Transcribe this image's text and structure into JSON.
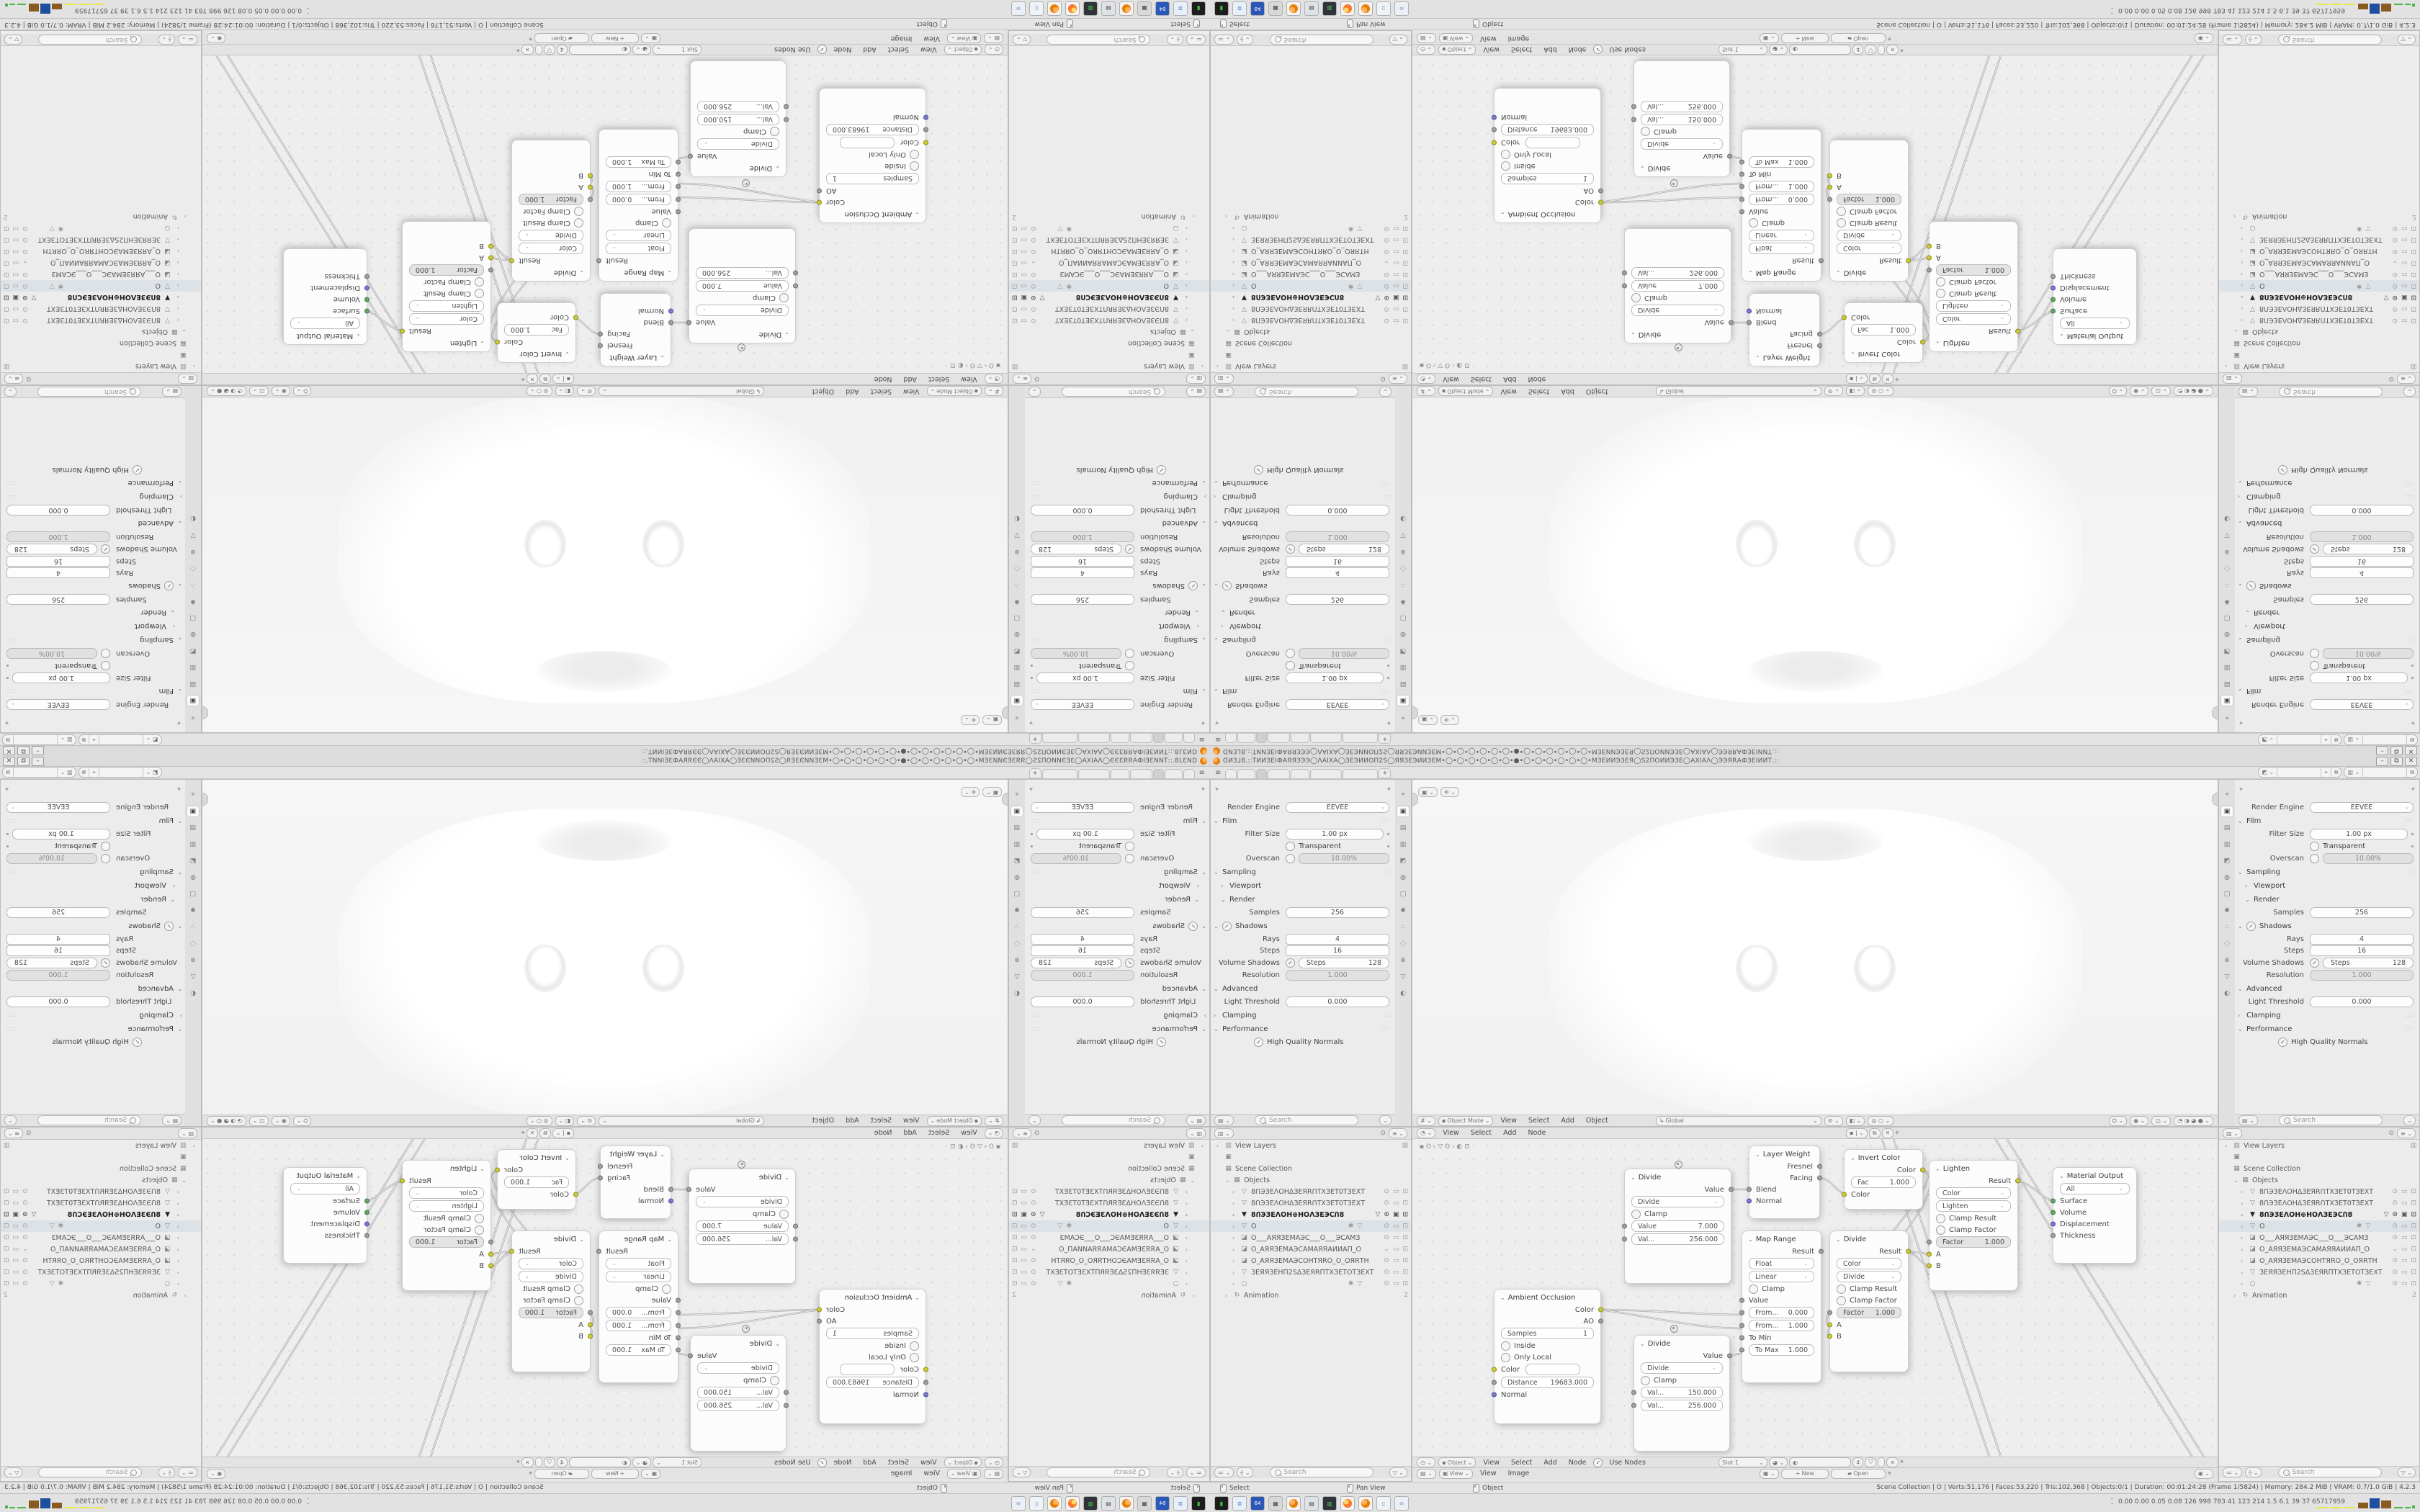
{
  "window": {
    "title": "ᗡИЗ⅃8.::ТИИЗЕІФАЯЯЗЭЭ◯ΛАІХА◯ЗЕЭИИОП2Ѕ◯ЯЯЗЕЭИИЗЕМ•◯•◯•◯•◯•◯•◯•●•◯•◯•◯•◯•◯•◯•МЗЕИИЭЗЕЯ◯Ѕ2ПОИИЭЗЕ◯АХІАΛ◯ЭЭЯRАФЗЕІИИТ.::",
    "minimize": "–",
    "restore": "⧉",
    "close": "✕"
  },
  "topbar": {
    "menu_icon": "≡",
    "new_tab": "+"
  },
  "viewport_header": {
    "mode": "Object Mode",
    "menus": [
      "View",
      "Select",
      "Add",
      "Object"
    ],
    "orientation": "Global"
  },
  "node_header_top": {
    "menus": [
      "View",
      "Select",
      "Add",
      "Node"
    ]
  },
  "node_header_bottom": {
    "context": "Object",
    "menus": [
      "View",
      "Select",
      "Add",
      "Node"
    ],
    "use_nodes": "Use Nodes",
    "slot": "Slot 1",
    "users_count": "4"
  },
  "image_header": {
    "view_value": "View",
    "menus": [
      "View",
      "Image"
    ],
    "new_label": "New",
    "open_label": "Open"
  },
  "properties": {
    "render_engine_label": "Render Engine",
    "render_engine": "EEVEE",
    "film": "Film",
    "filter_size_label": "Filter Size",
    "filter_size": "1.00 px",
    "transparent": "Transparent",
    "overscan_label": "Overscan",
    "overscan": "10.00%",
    "sampling": "Sampling",
    "viewport": "Viewport",
    "render": "Render",
    "samples_label": "Samples",
    "samples": "256",
    "shadows": "Shadows",
    "rays_label": "Rays",
    "rays": "4",
    "steps_label": "Steps",
    "steps": "16",
    "volume_shadows_label": "Volume Shadows",
    "volume_steps_label": "Steps",
    "volume_steps": "128",
    "resolution_label": "Resolution",
    "resolution": "1.000",
    "advanced": "Advanced",
    "light_threshold_label": "Light Threshold",
    "light_threshold": "0.000",
    "clamping": "Clamping",
    "performance": "Performance",
    "hq_normals": "High Quality Normals",
    "search_placeholder": "Search"
  },
  "outliner": {
    "view_layers": "View Layers",
    "scene_collection": "Scene Collection",
    "objects": "Objects",
    "animation": "Animation",
    "animation_badge": "2",
    "search_placeholder": "Search",
    "items": [
      {
        "name": "8ՈЭЗЕΛОНΔЗЕЯRՈТХЗЕТ0ТЗЕХТ"
      },
      {
        "name": "8ՈЭЗЕΛОНΔЗЕЯRՈТХЗЕТ0ТЗЕХТ"
      },
      {
        "name": "8ՈЭЗЕΛОН⊕НОΛЗЕЭCՈ8"
      },
      {
        "name": "O"
      },
      {
        "name": "O___АЯЯЗЕМАЭС___О___ЭСАМЗ"
      },
      {
        "name": "O_АЯЯЗЕМАЭСАМАЯЯАИИАП_О"
      },
      {
        "name": "O_АЯЯЗЕМАЭСОНТЯRО_O_ОЯRТН"
      },
      {
        "name": "ЗЕЯЯЗЕНП2ЅΔЗЕЯRПТХЗЕТОТЗЕХТ"
      },
      {
        "name": ""
      }
    ]
  },
  "nodes": {
    "divide1": {
      "title": "Divide",
      "out": "Value",
      "op": "Divide",
      "clamp": "Clamp",
      "f1_label": "Value",
      "f1_value": "7.000",
      "f2_label": "Val...",
      "f2_value": "256.000"
    },
    "divide2": {
      "title": "Divide",
      "out": "Value",
      "op": "Divide",
      "clamp": "Clamp",
      "f1_label": "Val...",
      "f1_value": "150.000",
      "f2_label": "Val...",
      "f2_value": "256.000"
    },
    "ambocc": {
      "title": "Ambient Occlusion",
      "out1": "Color",
      "out2": "AO",
      "samples_label": "Samples",
      "samples_value": "1",
      "inside": "Inside",
      "only_local": "Only Local",
      "color_label": "Color",
      "dist_label": "Distance",
      "dist_value": "19683.000",
      "normal": "Normal"
    },
    "maprange": {
      "title": "Map Range",
      "out": "Result",
      "type": "Float",
      "interp": "Linear",
      "clamp": "Clamp",
      "value": "Value",
      "from_min_label": "From...",
      "from_min": "0.000",
      "from_max_label": "From...",
      "from_max": "1.000",
      "to_min": "To Min",
      "to_max_label": "To Max",
      "to_max": "1.000"
    },
    "layerweight": {
      "title": "Layer Weight",
      "out1": "Fresnel",
      "out2": "Facing",
      "in1": "Blend",
      "in2": "Normal"
    },
    "invert": {
      "title": "Invert Color",
      "out": "Color",
      "fac_label": "Fac",
      "fac_value": "1.000",
      "in": "Color"
    },
    "dividemix": {
      "title": "Divide",
      "out": "Result",
      "type": "Color",
      "op": "Divide",
      "clamp1": "Clamp Result",
      "clamp2": "Clamp Factor",
      "factor_label": "Factor",
      "factor_value": "1.000",
      "a": "A",
      "b": "B"
    },
    "lighten": {
      "title": "Lighten",
      "out": "Result",
      "type": "Color",
      "op": "Lighten",
      "clamp1": "Clamp Result",
      "clamp2": "Clamp Factor",
      "factor_label": "Factor",
      "factor_value": "1.000",
      "a": "A",
      "b": "B"
    },
    "output": {
      "title": "Material Output",
      "target": "All",
      "in1": "Surface",
      "in2": "Volume",
      "in3": "Displacement",
      "in4": "Thickness"
    }
  },
  "node_graph": {
    "links": [
      "M261,237 C330,237 390,244 458,244",
      "M261,237 C340,248 392,263 458,263",
      "M440,301 C448,300 450,298 458,298",
      "M442,70 C452,70 458,70 468,70",
      "M565,54 C580,54 586,70 600,77",
      "M708,43 C758,52 540,252 580,258",
      "M708,43 C772,66 548,270 580,274",
      "M688,156 C702,157 706,158 718,160",
      "M688,156 C706,163 702,172 718,176",
      "M840,58 C864,64 870,80 890,86",
      "M648,-12 L806,456",
      "M664,-12 L822,456",
      "M802,-12 L1092,456",
      "M818,-12 L1108,456"
    ]
  },
  "status_bar": {
    "hint1": "Select",
    "hint2": "Pan View",
    "hint3": "Object",
    "stats": "Scene Collection | O | Verts:51,176 | Faces:53,220 | Tris:102,368 | Objects:0/1 | Duration: 00:01:24:28 (Frame 1/5824) | Memory: 284.2 MiB | VRAM: 0.7/1.0 GiB | 4.2.3"
  },
  "taskbar": {
    "stats": "0.00 0.00 0.05 0.08   126   998   783   41   123   214   1.5   6.1   39   37   65717959"
  },
  "colors": {
    "accent_orange": "#e87d00",
    "socket_yellow": "#cdcd33",
    "socket_purple": "#7a7ad0",
    "socket_green": "#66a566",
    "block_brown": "#8a5a1e",
    "block_blue": "#1e4e9e",
    "block_yellow": "#e8e84a",
    "block_green": "#4ab54a"
  }
}
